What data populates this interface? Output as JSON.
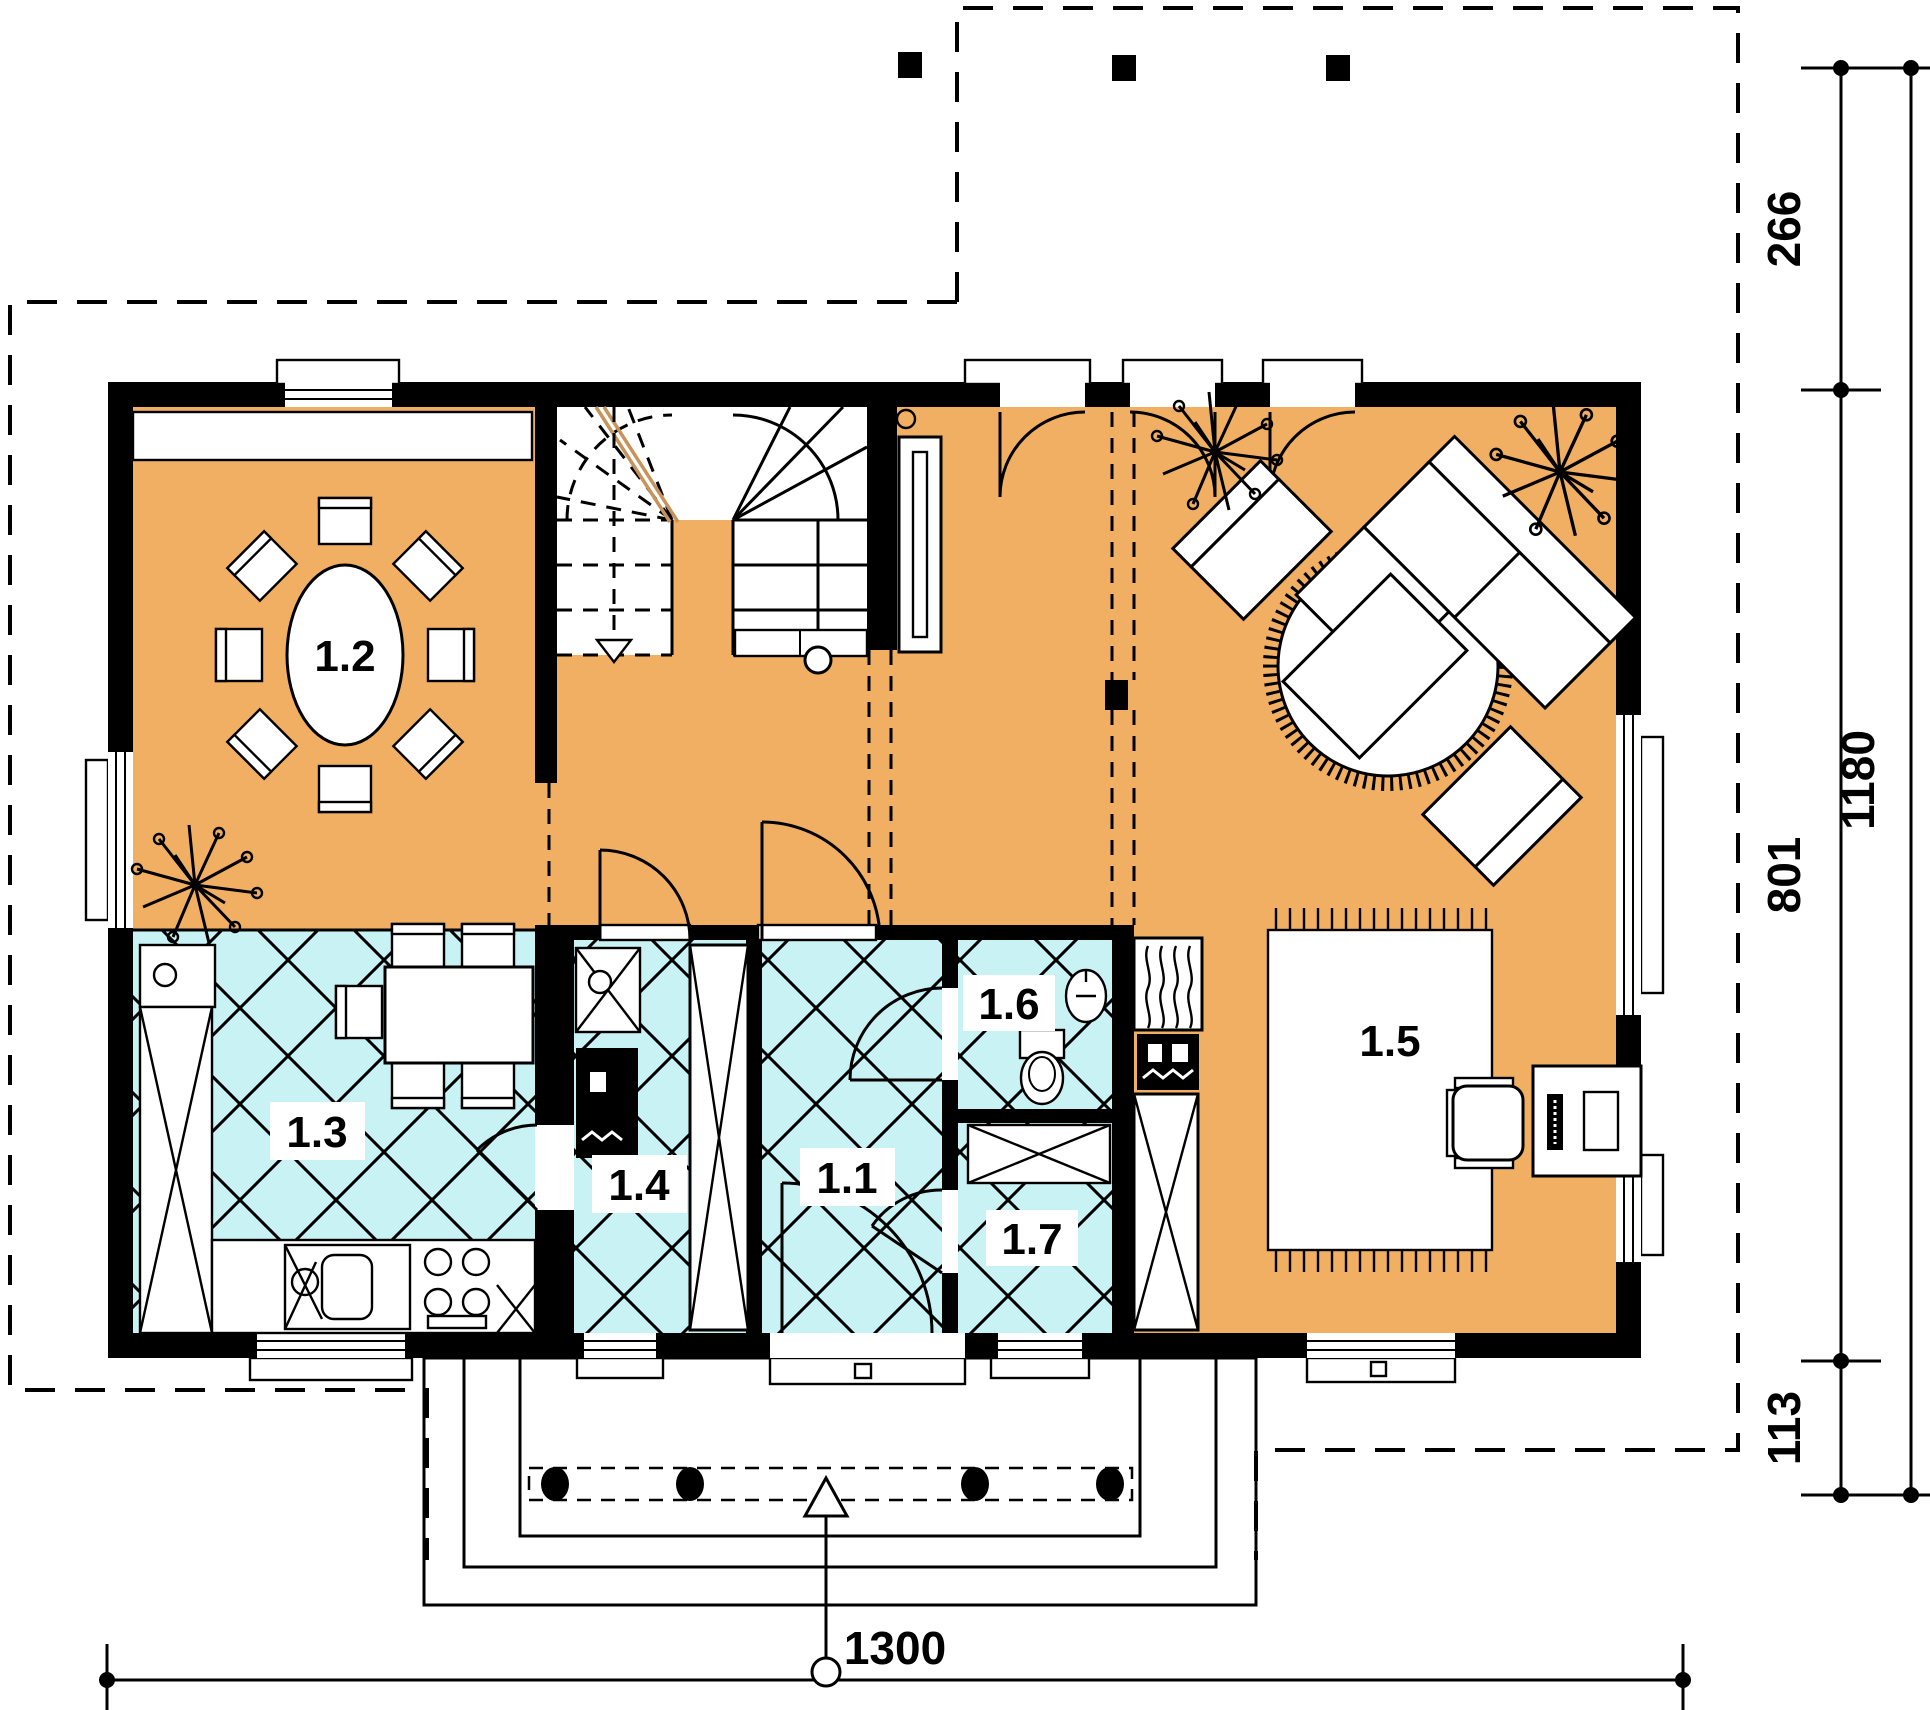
{
  "plan": {
    "type": "architectural-floor-plan-ground-floor",
    "rooms": [
      {
        "label": "1.1"
      },
      {
        "label": "1.2"
      },
      {
        "label": "1.3"
      },
      {
        "label": "1.4"
      },
      {
        "label": "1.5"
      },
      {
        "label": "1.6"
      },
      {
        "label": "1.7"
      }
    ],
    "dimensions": {
      "right_segments": [
        "266",
        "801",
        "113"
      ],
      "right_total": "1180",
      "bottom_total": "1300"
    },
    "colors": {
      "floor_living": "#F1AF63",
      "floor_tile": "#C9F2F4",
      "walls": "#000000",
      "paper": "#FFFFFF",
      "stair_break_line": "#C8935B"
    }
  }
}
